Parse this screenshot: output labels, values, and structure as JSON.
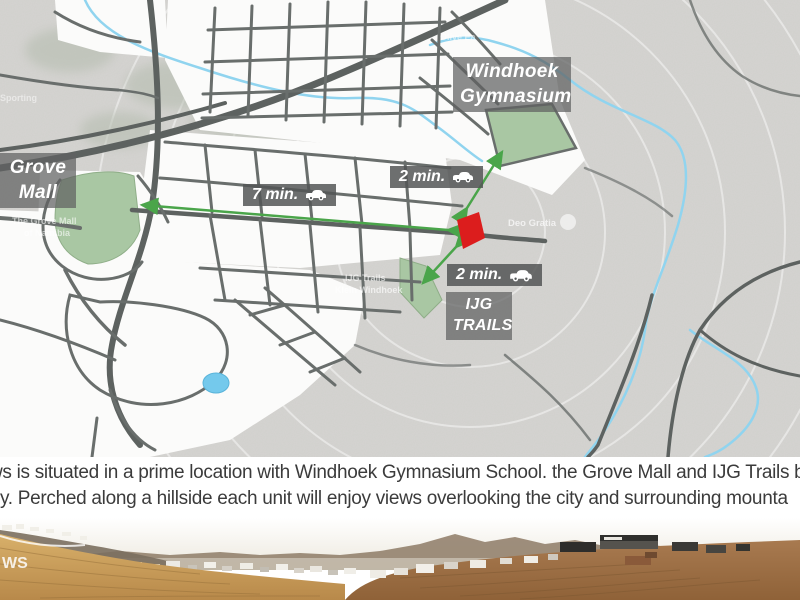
{
  "map": {
    "place_labels": {
      "grove_line1": "Grove",
      "grove_line2": "Mall",
      "gym_line1": "Windhoek",
      "gym_line2": "Gymnasium",
      "ijg_line1": "IJG",
      "ijg_line2": "TRAILS"
    },
    "travel_badges": {
      "grove_time": "7 min.",
      "gym_time": "2 min.",
      "ijg_time": "2 min."
    },
    "faint_labels": {
      "deo_gratia": "Deo Gratia",
      "ijg_small_line1": "IJG Trails",
      "ijg_small_line2": "Klein Windhoek",
      "grove_small_line1": "The Grove Mall",
      "grove_small_line2": "of Namibia",
      "sporting": "Sporting",
      "olive": "Olive Ea"
    },
    "colors": {
      "site_marker": "#dc1d1d",
      "green_area": "#a9c7a3",
      "arrow_green": "#4aa54a",
      "river_blue": "#90d4ef",
      "label_bg": "rgba(95,97,97,0.72)",
      "road_dark": "#5d6260"
    }
  },
  "description": {
    "line1": "ws is situated in a prime location with Windhoek Gymnasium School. the Grove Mall and IJG Trails b",
    "line2": "y. Perched along a hillside each unit will enjoy views overlooking the city and surrounding mounta"
  },
  "photo": {
    "watermark": "WS"
  }
}
